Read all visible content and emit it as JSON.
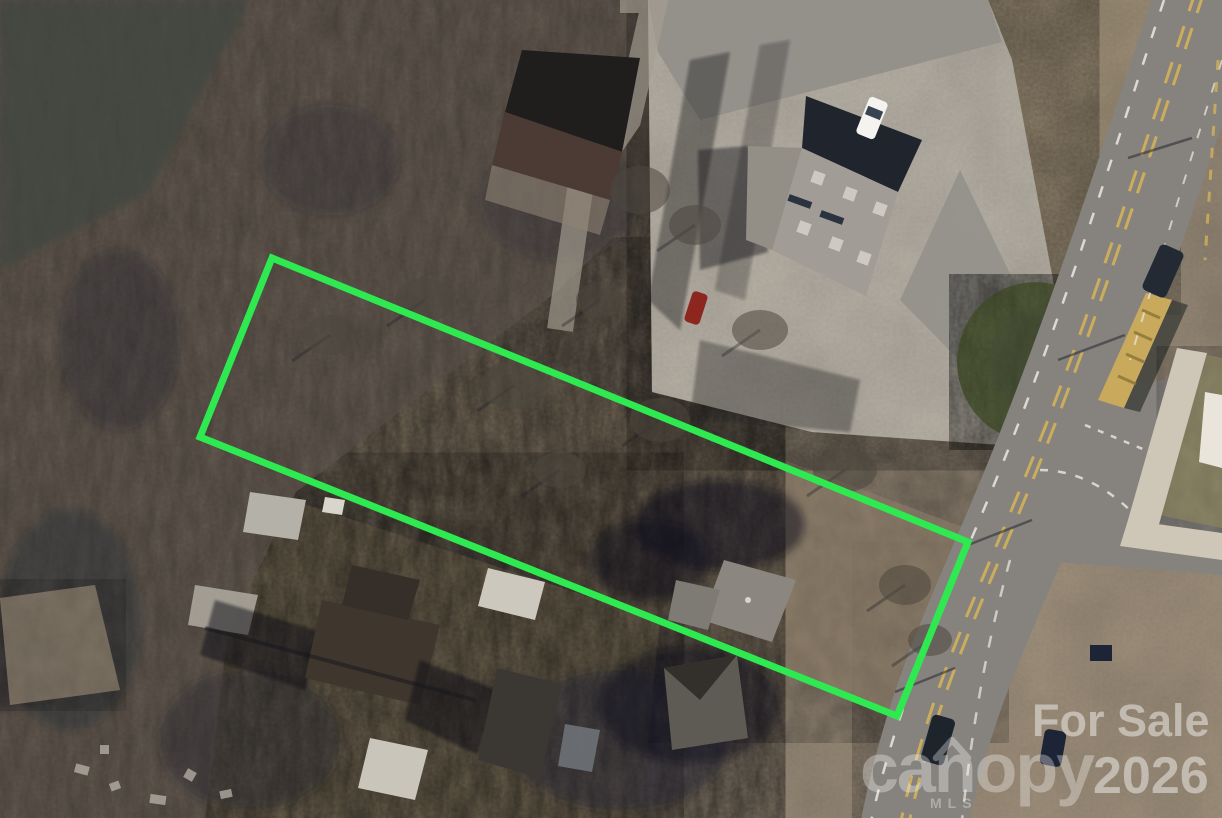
{
  "image": {
    "kind": "aerial-property-listing-photo",
    "width": 1222,
    "height": 818
  },
  "watermarks": {
    "for_sale": "For Sale",
    "year": "2026",
    "brand": "canopy",
    "brand_sub": "MLS",
    "color": "#ffffff"
  },
  "boundary": {
    "label": "property-parcel-outline",
    "color": "#2fe951",
    "stroke_width": "7",
    "points": "272,258 968,542 897,716 200,437"
  },
  "palette": {
    "field": "#9a8c7a",
    "field_light": "#a49580",
    "weeds": "#a2937a",
    "yards": "#84775f",
    "brush": "#8e7f6b",
    "forest": "#695f55",
    "forest_dark": "#41463f",
    "parking_concrete": "#bdb7ab",
    "parking_asphalt": "#94918b",
    "road": "#86837f",
    "marking_white": "#ece9e0",
    "marking_yellow": "#d3b158",
    "median_yellow": "#c9a95c",
    "sidewalk": "#cec7b8",
    "pad_white": "#e9e5da",
    "grass_wedge": "#8f8866",
    "shrub_green": "#59633f",
    "building_roof": "#a19c95",
    "building_roof_dark": "#20242d",
    "building_annex": "#938e86",
    "barn_black": "#201e1d",
    "barn_brown": "#4c3a34",
    "house_dark": "#3f362e",
    "house_dark2": "#3b3732",
    "house_gray": "#8b8780",
    "house_gray2": "#5e5a54",
    "shed": "#b4b1a8",
    "car_white": "#f4f3ef",
    "car_red": "#8e2620",
    "car_dark": "#232a33"
  }
}
